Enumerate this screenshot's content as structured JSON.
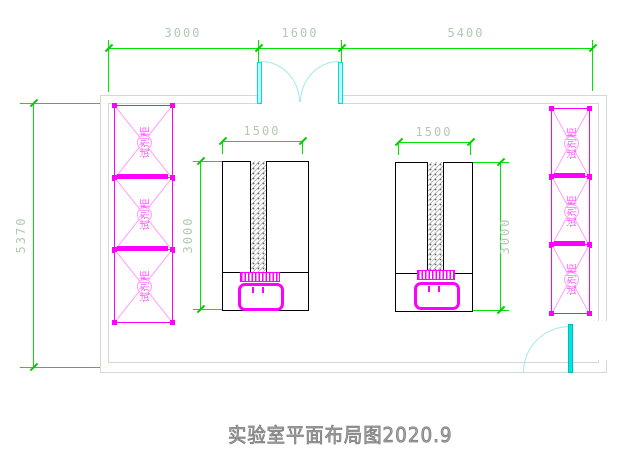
{
  "title": {
    "text": "实验室平面布局图2020.9"
  },
  "dimensions": {
    "top_left": "3000",
    "top_middle": "1600",
    "top_right": "5400",
    "left_overall": "5370",
    "bench_left_width": "1500",
    "bench_left_height": "3000",
    "bench_right_width": "1500",
    "bench_right_height": "3000"
  },
  "cabinets": {
    "label": "试剂柜"
  },
  "colors": {
    "dimension_line": "#00e600",
    "dimension_text": "#b2c9b2",
    "wall": "#d6d6d6",
    "cabinet": "#ff00ff",
    "cabinet_light": "#ff9dff",
    "door": "#00e5e5",
    "door_arc": "#a5e9e9",
    "bench_outline": "#000000",
    "title_text": "#7d7d7d"
  }
}
